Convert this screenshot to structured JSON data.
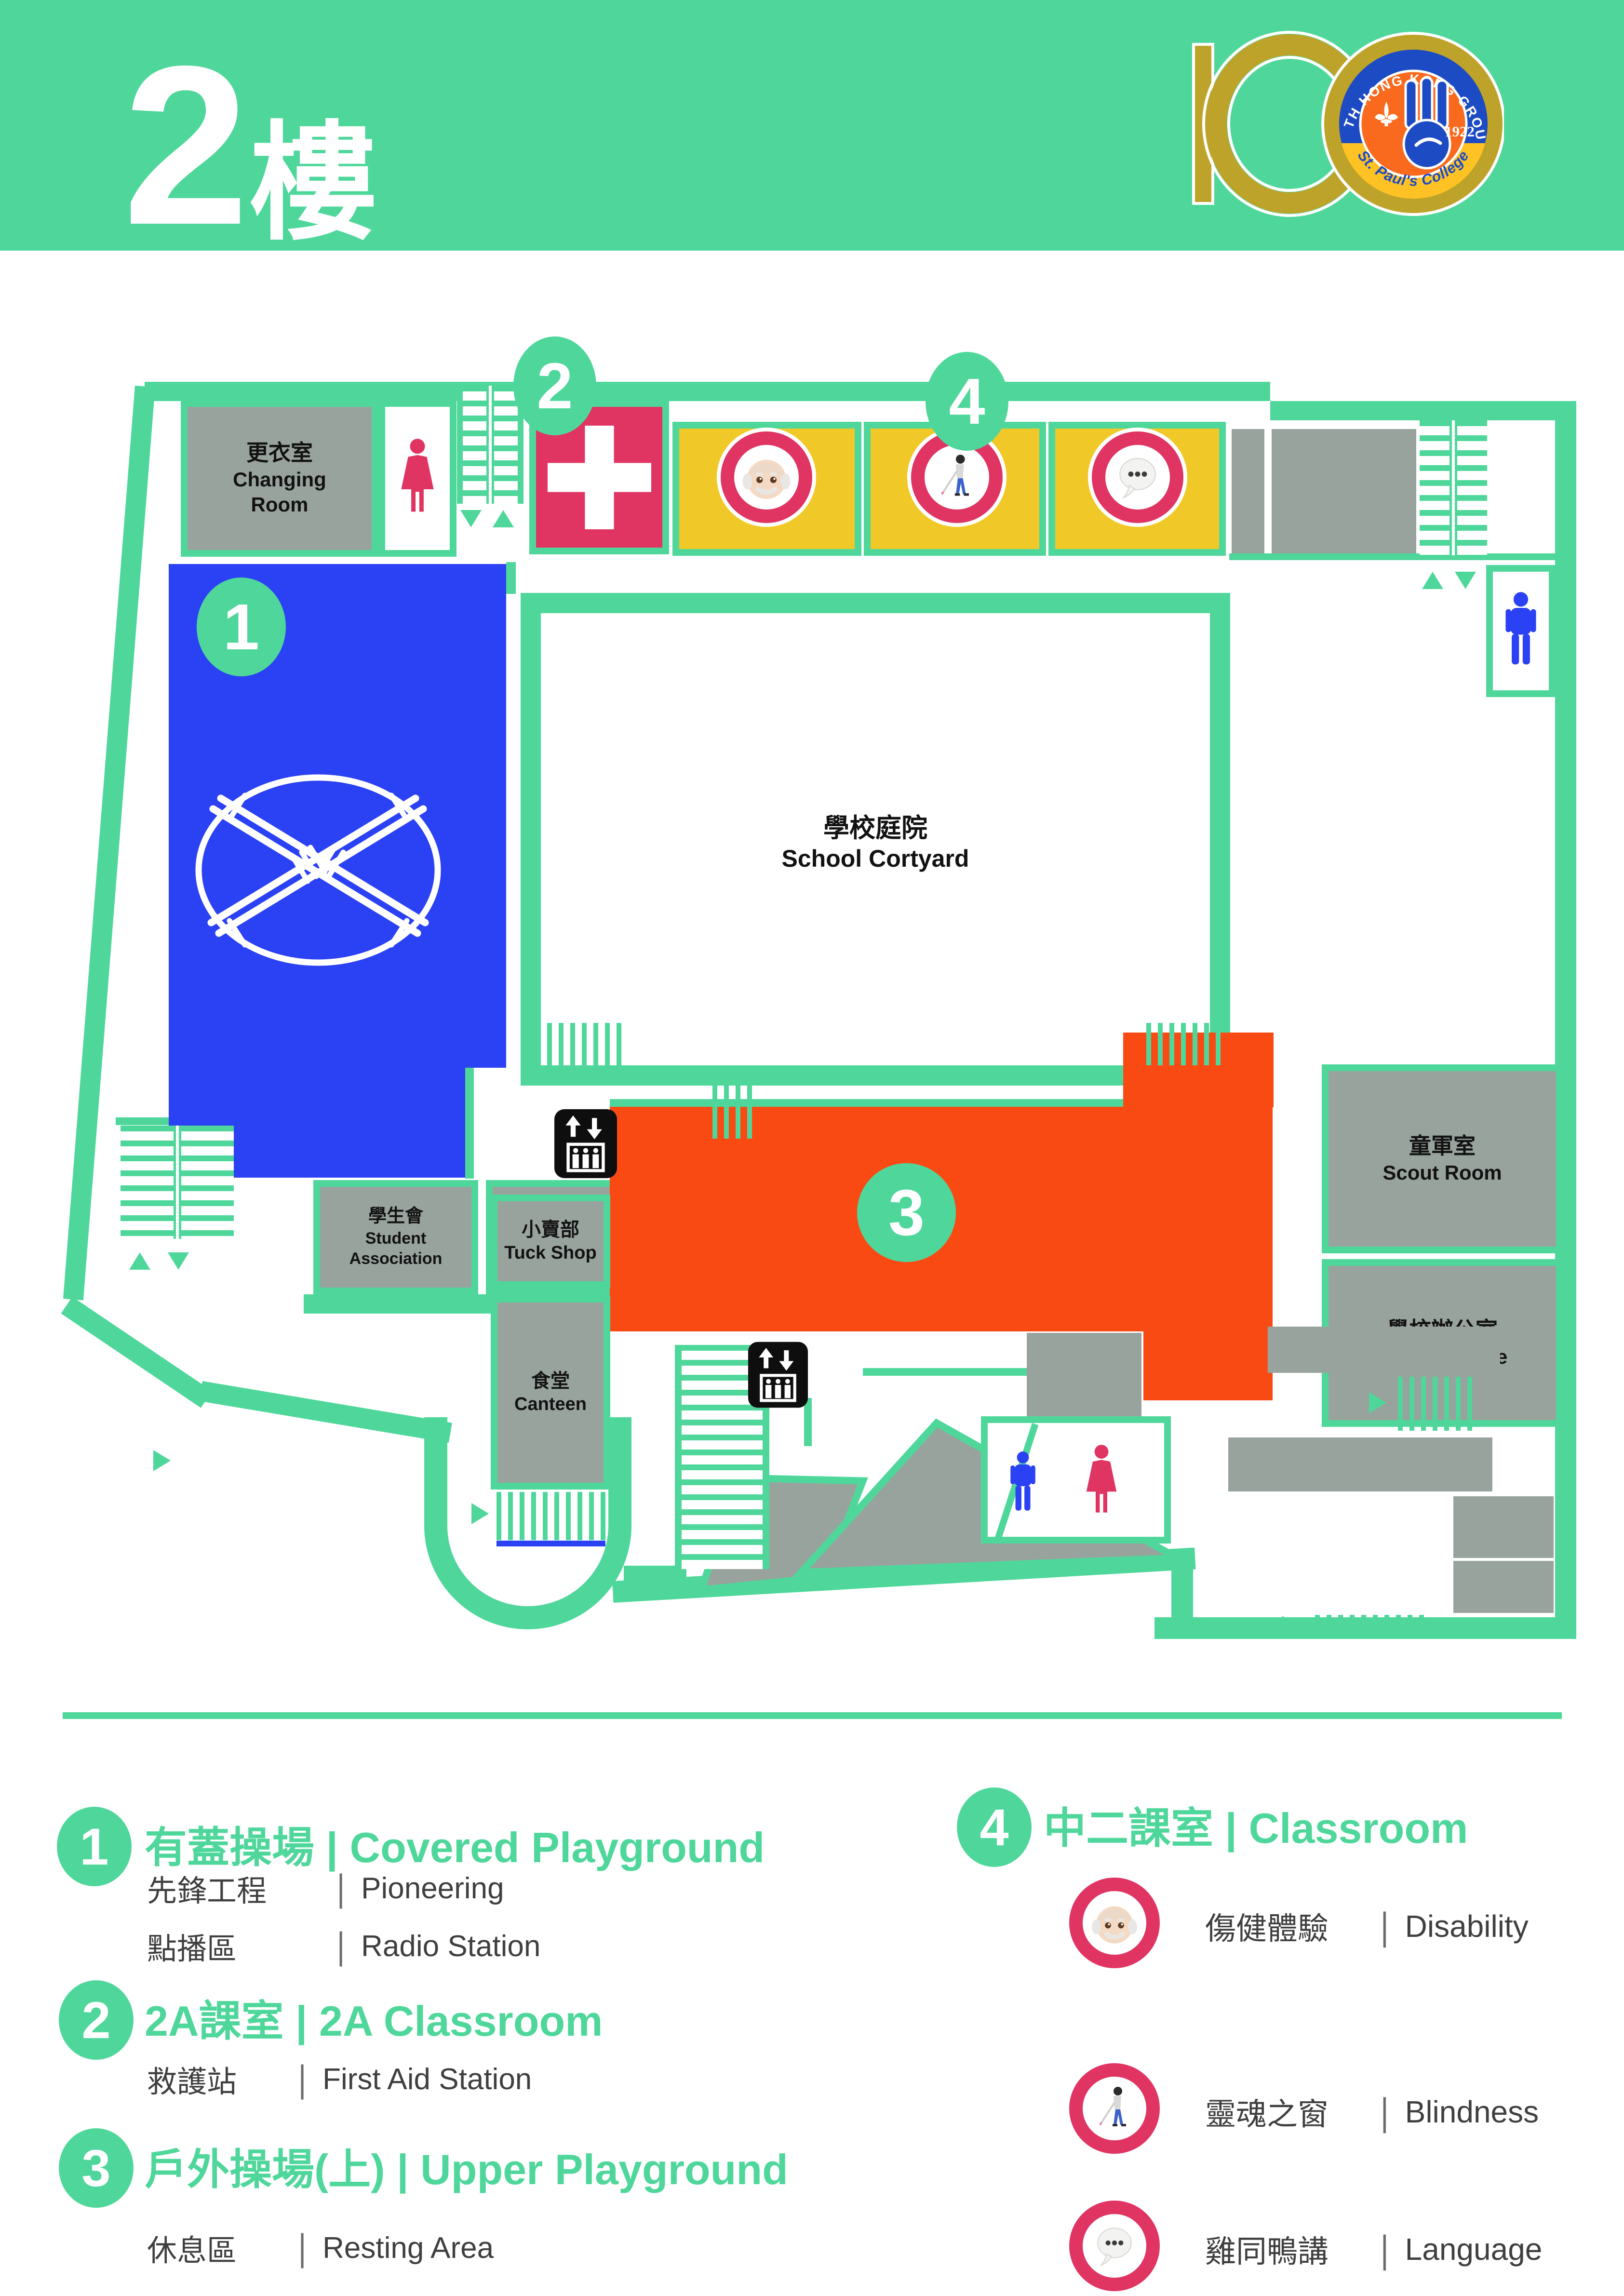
{
  "header": {
    "floor_num": "2",
    "floor_word": "樓"
  },
  "logo": {
    "number": "100",
    "group": "10 TH HONG KONG GROUP",
    "year": "1922",
    "school": "St. Paul's College"
  },
  "rooms": {
    "changing_zh": "更衣室",
    "changing_en": "Changing Room",
    "courtyard_zh": "學校庭院",
    "courtyard_en": "School Cortyard",
    "sa_zh": "學生會",
    "sa_en": "Student Association",
    "prefect_zh": "學長室",
    "prefect_en": "Prefect Room",
    "tuck_zh": "小賣部",
    "tuck_en": "Tuck Shop",
    "canteen_zh": "食堂",
    "canteen_en": "Canteen",
    "scout_zh": "童軍室",
    "scout_en": "Scout Room",
    "office_zh": "學校辦公室",
    "office_en": "School Office"
  },
  "markers": {
    "m1": "1",
    "m2": "2",
    "m3": "3",
    "m4": "4"
  },
  "icons": {
    "female_toilet": "female-figure",
    "male_toilet": "male-figure",
    "elevator": "elevator-up-down",
    "first_aid": "first-aid-cross",
    "old_man": "old-man-face-emoji",
    "blind": "person-with-white-cane-emoji",
    "speech": "speech-balloon-emoji",
    "pioneering": "pioneering-lashing"
  },
  "legend": {
    "sep": "|",
    "items": [
      {
        "num": "1",
        "title_zh": "有蓋操場",
        "title_en": "Covered Playground",
        "rows": [
          {
            "zh": "先鋒工程",
            "en": "Pioneering"
          },
          {
            "zh": "點播區",
            "en": "Radio Station"
          }
        ]
      },
      {
        "num": "2",
        "title_zh": "2A課室",
        "title_en": "2A Classroom",
        "rows": [
          {
            "zh": "救護站",
            "en": "First Aid Station"
          }
        ]
      },
      {
        "num": "3",
        "title_zh": "戶外操場(上)",
        "title_en": "Upper Playground",
        "rows": [
          {
            "zh": "休息區",
            "en": "Resting Area"
          }
        ]
      },
      {
        "num": "4",
        "title_zh": "中二課室",
        "title_en": "Classroom",
        "rows": [
          {
            "zh": "傷健體驗",
            "en": "Disability"
          },
          {
            "zh": "靈魂之窗",
            "en": "Blindness"
          },
          {
            "zh": "雞同鴨講",
            "en": "Language"
          }
        ]
      }
    ]
  },
  "colors": {
    "accent_green": "#4FD79B",
    "pink": "#E03463",
    "yellow": "#F0C929",
    "blue": "#2B41F4",
    "orange": "#FA4A14",
    "room_gray": "#98A39D",
    "gold": "#BEA32B"
  }
}
